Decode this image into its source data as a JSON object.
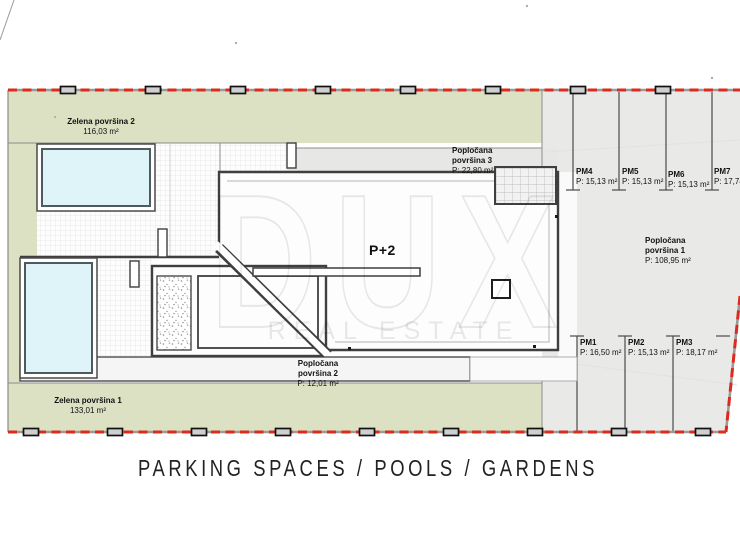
{
  "title": "PARKING SPACES / POOLS / GARDENS",
  "watermark": {
    "brand": "DUX",
    "tagline": "REAL ESTATE"
  },
  "building": {
    "label": "P+2"
  },
  "gardens": [
    {
      "name": "Zelena površina 2",
      "area": "116,03 m²"
    },
    {
      "name": "Zelena površina 1",
      "area": "133,01 m²"
    }
  ],
  "paved_areas": [
    {
      "name": "Popločana površina 1",
      "area": "P: 108,95 m²"
    },
    {
      "name": "Popločana površina 2",
      "area": "P: 12,01 m²"
    },
    {
      "name": "Popločana površina 3",
      "area": "P: 22,80 m²"
    }
  ],
  "parking_spaces": [
    {
      "id": "PM1",
      "area": "P: 16,50 m²"
    },
    {
      "id": "PM2",
      "area": "P: 15,13 m²"
    },
    {
      "id": "PM3",
      "area": "P: 18,17 m²"
    },
    {
      "id": "PM4",
      "area": "P: 15,13 m²"
    },
    {
      "id": "PM5",
      "area": "P: 15,13 m²"
    },
    {
      "id": "PM6",
      "area": "P: 15,13 m²"
    },
    {
      "id": "PM7",
      "area": "P: 17,74 m²"
    }
  ],
  "colors": {
    "garden_green": "#dde1c4",
    "pool_blue": "#dff4f9",
    "parking_gray": "#e9e9e8",
    "boundary_red": "#dc2b1c",
    "wall_dark": "#3f3f3f"
  }
}
